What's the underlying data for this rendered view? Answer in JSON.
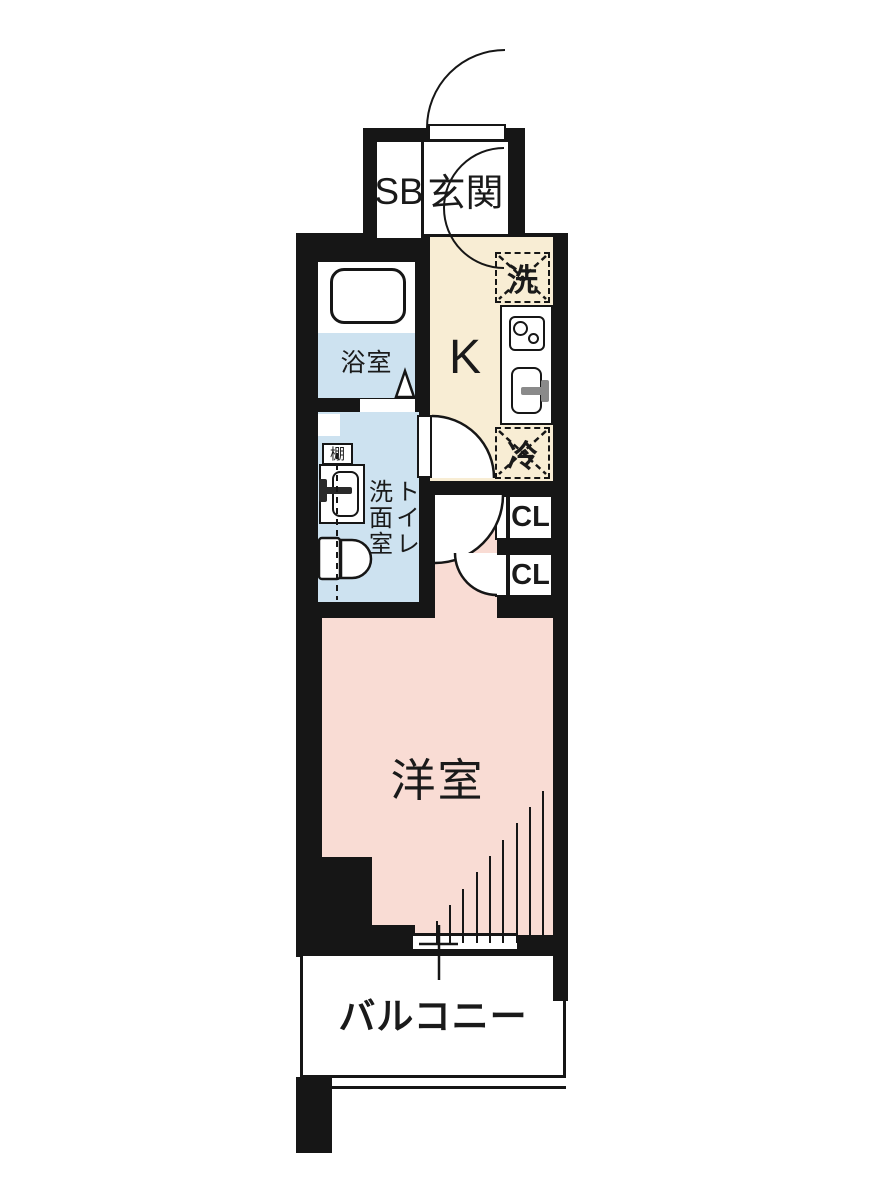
{
  "floorplan": {
    "type": "japanese-apartment-1K-floor-plan",
    "entrance_label": "玄関",
    "shoebox_label": "SB",
    "kitchen_label": "K",
    "bathroom_label": "浴室",
    "washroom_label_right_column": "トイレ",
    "washroom_label_left_column": "洗面室",
    "shelf_label": "棚",
    "washer_label": "洗",
    "fridge_label": "冷",
    "closet_upper_label": "CL",
    "closet_lower_label": "CL",
    "western_room_label": "洋室",
    "balcony_label": "バルコニー"
  },
  "colors": {
    "wall": "#161616",
    "kitchen_floor": "#f8edd4",
    "wet_area_floor": "#cde2f0",
    "room_floor": "#f9dcd4",
    "floor_white": "#ffffff"
  }
}
